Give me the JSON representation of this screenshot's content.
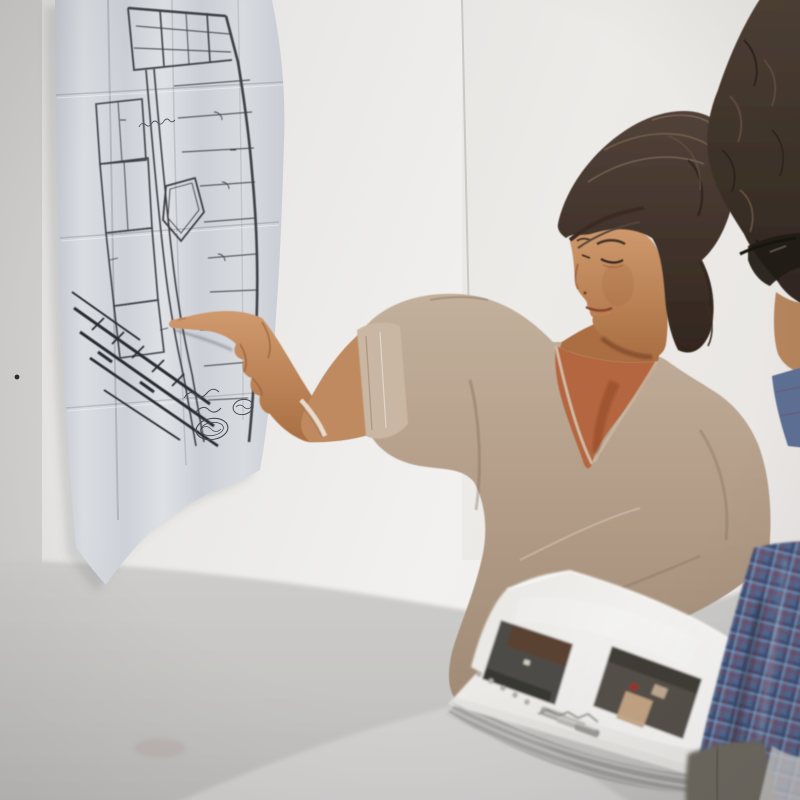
{
  "meta": {
    "description": "Photograph: a woman with dark hair in a bun, wearing a beige scoop-neck sweater, points with her right index finger at a folded architectural floor plan taped to a white wall. A second person with curly hair and eyeglasses, wearing a blue plaid shirt, stands at the right beside a pale table holding a plastic-sleeved binder page with two printed interior photographs and a metal clip.",
    "width": 800,
    "height": 800
  },
  "scene": {
    "wall": {
      "label": "white gallery wall",
      "color": "#eceae7",
      "left_edge_color": "#d7d6d4",
      "nail_hole_color": "#2b2a28"
    },
    "floor_plan": {
      "label": "folded architectural floor-plan print taped to wall",
      "paper_color": "#d2d5da",
      "ink_color": "#3f3f47",
      "features": [
        "thick wall linework",
        "room partitions",
        "central diamond-shaped room",
        "dense hatched band",
        "handwritten cursive annotation",
        "two oval stamp marks",
        "signature squiggles",
        "fold creases"
      ]
    },
    "woman": {
      "label": "woman pointing at floor plan",
      "hair_color": "#42352c",
      "hair_highlight": "#8a7258",
      "skin_color": "#c08a60",
      "chest_color": "#b4663f",
      "sweater_color": "#b39d88",
      "bracelet_color": "#ece5da",
      "action": "pointing with right index finger at plan"
    },
    "companion": {
      "label": "person with curly hair and eyeglasses",
      "hair_color": "#44372c",
      "skin_color": "#b5855c",
      "glasses_color": "#241d18",
      "shirt": "blue plaid",
      "shirt_base": "#51688f",
      "shirt_grid": "#3d4e72",
      "shirt_accent": "#7a4659",
      "pants_color": "#6d675f"
    },
    "table": {
      "label": "pale table surface, out of focus",
      "color": "#c8c7c5",
      "highlight": "#d6d5d3"
    },
    "binder": {
      "label": "plastic sleeve page with two printed photos",
      "page_color": "#f1f0ee",
      "hardware": "metal clip and punched holes",
      "hole_color": "#b5b4b1",
      "clip_color": "#a9a7a4",
      "photos": [
        {
          "label": "dark interior print with brown ceiling wedge",
          "color": "#4e4c46",
          "accent": "#5a4233"
        },
        {
          "label": "interior print with beige bed and red object",
          "color": "#544f48",
          "beige_color": "#c3a484",
          "red_color": "#9c3226"
        }
      ]
    }
  }
}
